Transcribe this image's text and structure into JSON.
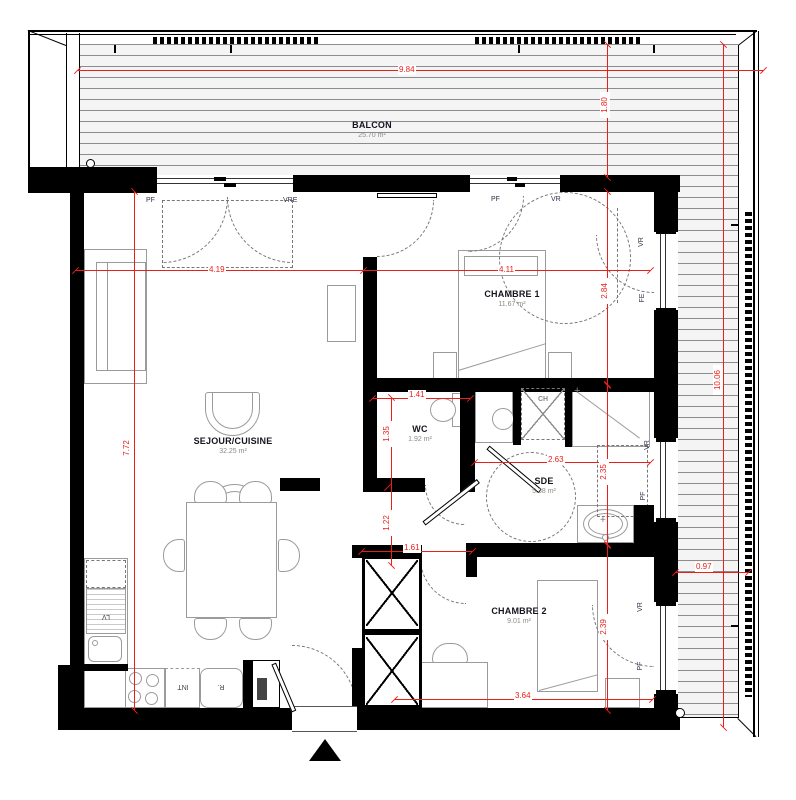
{
  "rooms": {
    "balcon": {
      "name": "BALCON",
      "area": "25.70 m²"
    },
    "sejour": {
      "name": "SEJOUR/CUISINE",
      "area": "32.25 m²"
    },
    "ch1": {
      "name": "CHAMBRE 1",
      "area": "11.67 m²"
    },
    "wc": {
      "name": "WC",
      "area": "1.92 m²"
    },
    "sde": {
      "name": "SDE",
      "area": "5.38 m²"
    },
    "ch2": {
      "name": "CHAMBRE 2",
      "area": "9.01 m²"
    }
  },
  "dims": {
    "total_width": "9.84",
    "balcony_depth": "1.80",
    "sejour_w": "4.19",
    "ch1_w": "4.11",
    "ch1_h": "2.84",
    "sde_h": "2.35",
    "ch2_h": "2.39",
    "right_total": "10.06",
    "sejour_h": "7.72",
    "wc_w": "1.41",
    "wc_h": "1.35",
    "sde_w": "2.63",
    "hall_h": "1.22",
    "hall_w": "1.61",
    "ch2_w": "3.64",
    "balcony_side_w": "0.97"
  },
  "openings": {
    "w1_left": "PF",
    "w1_right": "VRE",
    "w2_left": "PF",
    "w2_right": "VR",
    "fe_top": "VR",
    "fe_bottom": "FE",
    "sde_top": "VR",
    "sde_bottom": "PF",
    "ch2_top": "VR",
    "ch2_bottom": "PF"
  },
  "kitchen": {
    "dishwasher": "LV",
    "oven": "INT",
    "fridge": "R.",
    "water_heater": "CH"
  },
  "colors": {
    "dimension_red": "#e9201a",
    "wall_black": "#000000",
    "furniture_gray": "#9b9b9b",
    "label_ink": "#14141e"
  }
}
